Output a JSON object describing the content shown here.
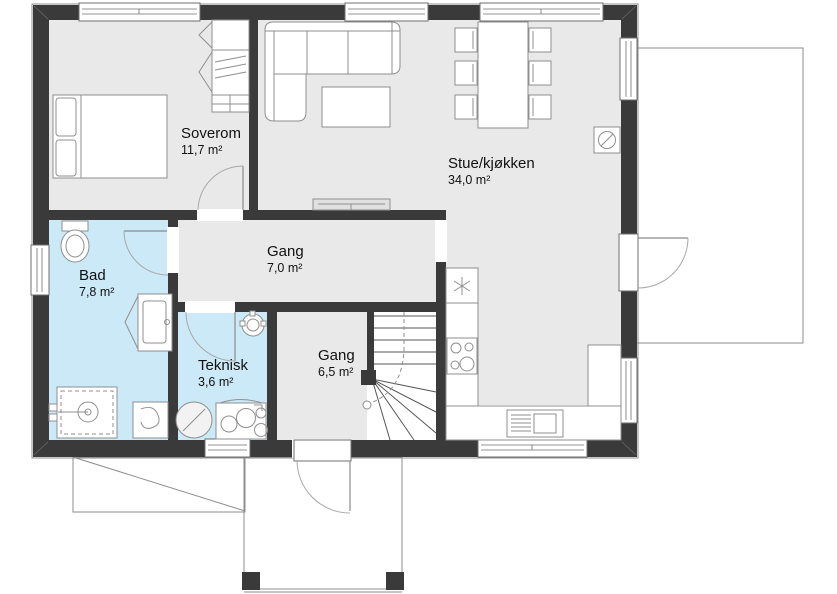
{
  "plan": {
    "rooms": [
      {
        "name": "Soverom",
        "area": "11,7 m²"
      },
      {
        "name": "Stue/kjøkken",
        "area": "34,0 m²"
      },
      {
        "name": "Gang",
        "area": "7,0 m²"
      },
      {
        "name": "Bad",
        "area": "7,8 m²"
      },
      {
        "name": "Teknisk",
        "area": "3,6 m²"
      },
      {
        "name": "Gang",
        "area": "6,5 m²"
      }
    ],
    "colors": {
      "wall": "#3a3a3a",
      "floor": "#e9e9e9",
      "wet_room_floor": "#cbe9f7",
      "fixture_outline": "#8f8f8f",
      "background": "#ffffff"
    }
  }
}
